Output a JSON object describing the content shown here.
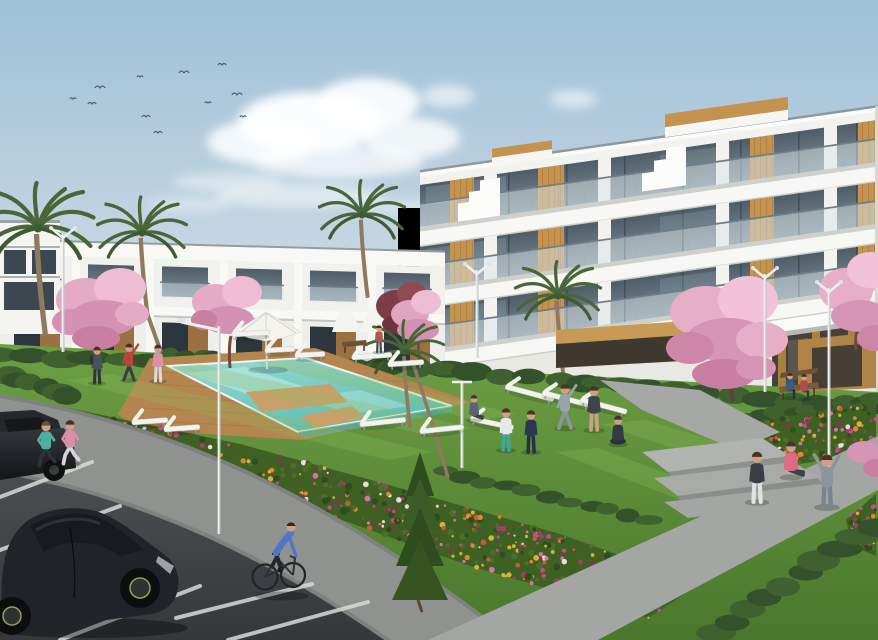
{
  "meta": {
    "type": "architectural-exterior-render",
    "description": "Daytime render of a modern white apartment complex with stepped glass terraces and wood accents, communal lawn with turquoise pool and sun loungers, cherry-blossom trees, palm trees, flower beds, walkways with people exercising, a cyclist, joggers and a parking lane with black cars under a pale blue sky with a flock of birds."
  },
  "scene": {
    "palette": {
      "sky_top": "#9fc0d8",
      "sky_mid": "#c2d5e2",
      "sky_horizon": "#e7ecee",
      "cloud": "#ffffff",
      "building_white": "#f2f2ee",
      "building_shade": "#e9e8e3",
      "slab_white": "#f7f7f3",
      "glass_dark": "#4e5c66",
      "glass_light": "#7c8d97",
      "railing": "#d9e4e8",
      "wood": "#c4934f",
      "wood_dark": "#a97c3e",
      "grass_light": "#6d9f44",
      "grass_dark": "#4a772c",
      "hedge": "#33512a",
      "pool_light": "#9adbd4",
      "pool_deep": "#5fbdb5",
      "deck": "#b5854f",
      "path_gray": "#a3a6a2",
      "bike_path": "#8f928f",
      "asphalt_top": "#515356",
      "asphalt_bottom": "#35373a",
      "line_white": "#d9dbd8",
      "car_black": "#202327",
      "blossom": "#e7aec8",
      "blossom_deep": "#d795b5",
      "palm_green": "#486638",
      "conifer_green": "#2e4c1e"
    },
    "sky": {
      "birds": [
        [
          73,
          99
        ],
        [
          92,
          104
        ],
        [
          100,
          88
        ],
        [
          140,
          77
        ],
        [
          146,
          117
        ],
        [
          184,
          73
        ],
        [
          208,
          103
        ],
        [
          222,
          65
        ],
        [
          237,
          95
        ],
        [
          243,
          117
        ],
        [
          158,
          133
        ]
      ],
      "clouds": [
        [
          310,
          122,
          72,
          30,
          0.95
        ],
        [
          368,
          102,
          52,
          24,
          0.9
        ],
        [
          262,
          142,
          55,
          22,
          0.85
        ],
        [
          412,
          138,
          48,
          20,
          0.8
        ],
        [
          338,
          162,
          85,
          16,
          0.7
        ],
        [
          448,
          96,
          26,
          11,
          0.6
        ],
        [
          573,
          99,
          24,
          9,
          0.55
        ],
        [
          300,
          196,
          85,
          12,
          0.5
        ],
        [
          228,
          182,
          55,
          9,
          0.45
        ],
        [
          188,
          205,
          42,
          7,
          0.4
        ],
        [
          415,
          208,
          60,
          8,
          0.35
        ],
        [
          700,
          195,
          55,
          7,
          0.25
        ],
        [
          845,
          222,
          70,
          9,
          0.22
        ]
      ]
    },
    "flower_colors": [
      "#c9488f",
      "#de6fae",
      "#e0872f",
      "#d9b13c",
      "#a93b67",
      "#ecd9e4",
      "#c95a3c",
      "#8a2f56"
    ],
    "beds": [
      {
        "name": "flowerbed-main",
        "seed": 7,
        "count": 430,
        "poly": [
          [
            40,
            402
          ],
          [
            240,
            444
          ],
          [
            400,
            488
          ],
          [
            560,
            534
          ],
          [
            700,
            584
          ],
          [
            648,
            618
          ],
          [
            470,
            566
          ],
          [
            320,
            512
          ],
          [
            180,
            458
          ],
          [
            80,
            434
          ]
        ]
      },
      {
        "name": "flowerbed-right",
        "seed": 13,
        "count": 140,
        "poly": [
          [
            714,
            430
          ],
          [
            876,
            400
          ],
          [
            876,
            452
          ],
          [
            760,
            470
          ]
        ]
      },
      {
        "name": "flowerbed-corner",
        "seed": 21,
        "count": 40,
        "poly": [
          [
            846,
            520
          ],
          [
            876,
            494
          ],
          [
            876,
            556
          ],
          [
            852,
            546
          ]
        ]
      }
    ],
    "hedges_back": [
      {
        "x1": 0,
        "y1": 356,
        "x2": 445,
        "y2": 368,
        "n": 16,
        "rx": 19,
        "ry": 8
      },
      {
        "x1": 445,
        "y1": 370,
        "x2": 876,
        "y2": 408,
        "n": 16,
        "rx": 18,
        "ry": 8
      },
      {
        "x1": 598,
        "y1": 384,
        "x2": 795,
        "y2": 432,
        "n": 10,
        "rx": 13,
        "ry": 6
      },
      {
        "x1": 712,
        "y1": 424,
        "x2": 876,
        "y2": 398,
        "n": 11,
        "rx": 13,
        "ry": 6
      },
      {
        "x1": 6,
        "y1": 376,
        "x2": 70,
        "y2": 394,
        "n": 6,
        "rx": 15,
        "ry": 8
      },
      {
        "x1": 172,
        "y1": 354,
        "x2": 216,
        "y2": 357,
        "n": 4,
        "rx": 11,
        "ry": 6
      }
    ],
    "hedges_front": [
      {
        "x1": 714,
        "y1": 634,
        "x2": 876,
        "y2": 526,
        "n": 10,
        "rx": 20,
        "ry": 9
      },
      {
        "x1": 446,
        "y1": 472,
        "x2": 652,
        "y2": 520,
        "n": 11,
        "rx": 14,
        "ry": 6
      }
    ],
    "loungers": [
      [
        232,
        336,
        38,
        -3
      ],
      [
        265,
        352,
        30,
        -3
      ],
      [
        295,
        357,
        30,
        -3
      ],
      [
        352,
        359,
        40,
        -4
      ],
      [
        388,
        366,
        36,
        -4
      ],
      [
        132,
        424,
        36,
        -4
      ],
      [
        164,
        431,
        36,
        -4
      ],
      [
        360,
        426,
        46,
        -6
      ],
      [
        420,
        433,
        44,
        -6
      ],
      [
        505,
        388,
        50,
        15
      ],
      [
        542,
        394,
        50,
        15
      ],
      [
        580,
        401,
        48,
        15
      ],
      [
        470,
        420,
        44,
        12
      ]
    ],
    "lamps": [
      {
        "x": 219,
        "top": 326,
        "bot": 534,
        "type": "arm",
        "alen": 38
      },
      {
        "x": 63,
        "top": 234,
        "bot": 352,
        "type": "v"
      },
      {
        "x": 477,
        "top": 270,
        "bot": 358,
        "type": "v"
      },
      {
        "x": 462,
        "top": 382,
        "bot": 468,
        "type": "t"
      },
      {
        "x": 765,
        "top": 274,
        "bot": 392,
        "type": "v"
      },
      {
        "x": 829,
        "top": 288,
        "bot": 472,
        "type": "v"
      }
    ],
    "parking_lines": [
      [
        0,
        497,
        92,
        462
      ],
      [
        0,
        550,
        120,
        506
      ],
      [
        10,
        608,
        150,
        553
      ],
      [
        60,
        640,
        200,
        586
      ],
      [
        176,
        618,
        312,
        584
      ],
      [
        228,
        640,
        368,
        602
      ]
    ],
    "people": [
      {
        "name": "jogger-1",
        "pose": "jog",
        "x": 46,
        "y": 466,
        "s": 2.1,
        "shirt": "#4fae9f",
        "pants": "#2e3338",
        "hair": "#6b4f35"
      },
      {
        "name": "jogger-2",
        "pose": "jog",
        "x": 70,
        "y": 464,
        "s": 2.05,
        "shirt": "#d98fa5",
        "pants": "#d4d6d8",
        "hair": "#3c2f26"
      },
      {
        "name": "walker-backpack",
        "pose": "stand",
        "x": 97,
        "y": 383,
        "s": 1.7,
        "shirt": "#49525b",
        "pants": "#2f343a"
      },
      {
        "name": "stretcher-red",
        "pose": "stretch",
        "x": 129,
        "y": 380,
        "s": 1.7,
        "shirt": "#b8433a",
        "pants": "#3a3f46"
      },
      {
        "name": "walker-pink",
        "pose": "stand",
        "x": 158,
        "y": 381,
        "s": 1.7,
        "shirt": "#db93a4",
        "pants": "#d8dadc"
      },
      {
        "name": "sitter-lounger",
        "pose": "sitfloor",
        "x": 474,
        "y": 420,
        "s": 1.55,
        "shirt": "#5b6470",
        "pants": "#3a4047"
      },
      {
        "name": "woman-teal",
        "pose": "stand",
        "x": 506,
        "y": 450,
        "s": 1.95,
        "shirt": "#e8e8ea",
        "pants": "#3fa89d"
      },
      {
        "name": "tracksuit-navy",
        "pose": "stand",
        "x": 531,
        "y": 452,
        "s": 1.95,
        "shirt": "#2c3655",
        "pants": "#262e48"
      },
      {
        "name": "stretcher-gray",
        "pose": "stretch",
        "x": 565,
        "y": 428,
        "s": 2.05,
        "shirt": "#99a3ab",
        "pants": "#8a949c"
      },
      {
        "name": "man-shorts",
        "pose": "stand",
        "x": 594,
        "y": 430,
        "s": 2.05,
        "shirt": "#3d434a",
        "pants": "#caa185"
      },
      {
        "name": "meditator",
        "pose": "meditate",
        "x": 618,
        "y": 444,
        "s": 1.85,
        "shirt": "#343b46",
        "pants": "#2c323c"
      },
      {
        "name": "woman-path",
        "pose": "stand",
        "x": 757,
        "y": 502,
        "s": 2.35,
        "shirt": "#3a3f47",
        "pants": "#e0e2e4"
      },
      {
        "name": "sitter-pink",
        "pose": "sitfloor",
        "x": 791,
        "y": 477,
        "s": 2.2,
        "shirt": "#e06a84",
        "pants": "#3c4148"
      },
      {
        "name": "arms-up",
        "pose": "armsup",
        "x": 827,
        "y": 507,
        "s": 2.45,
        "shirt": "#8d959c",
        "pants": "#7b848c"
      },
      {
        "name": "bench-sitter-blue",
        "pose": "sit",
        "x": 790,
        "y": 398,
        "s": 1.3,
        "shirt": "#3b5a8c",
        "pants": "#2c3136"
      },
      {
        "name": "bench-sitter-red",
        "pose": "sit",
        "x": 804,
        "y": 399,
        "s": 1.3,
        "shirt": "#b04a52",
        "pants": "#33383d"
      },
      {
        "name": "walker-courtyard",
        "pose": "stand",
        "x": 379,
        "y": 352,
        "s": 1.25,
        "shirt": "#b5564e",
        "pants": "#46505a"
      }
    ]
  }
}
